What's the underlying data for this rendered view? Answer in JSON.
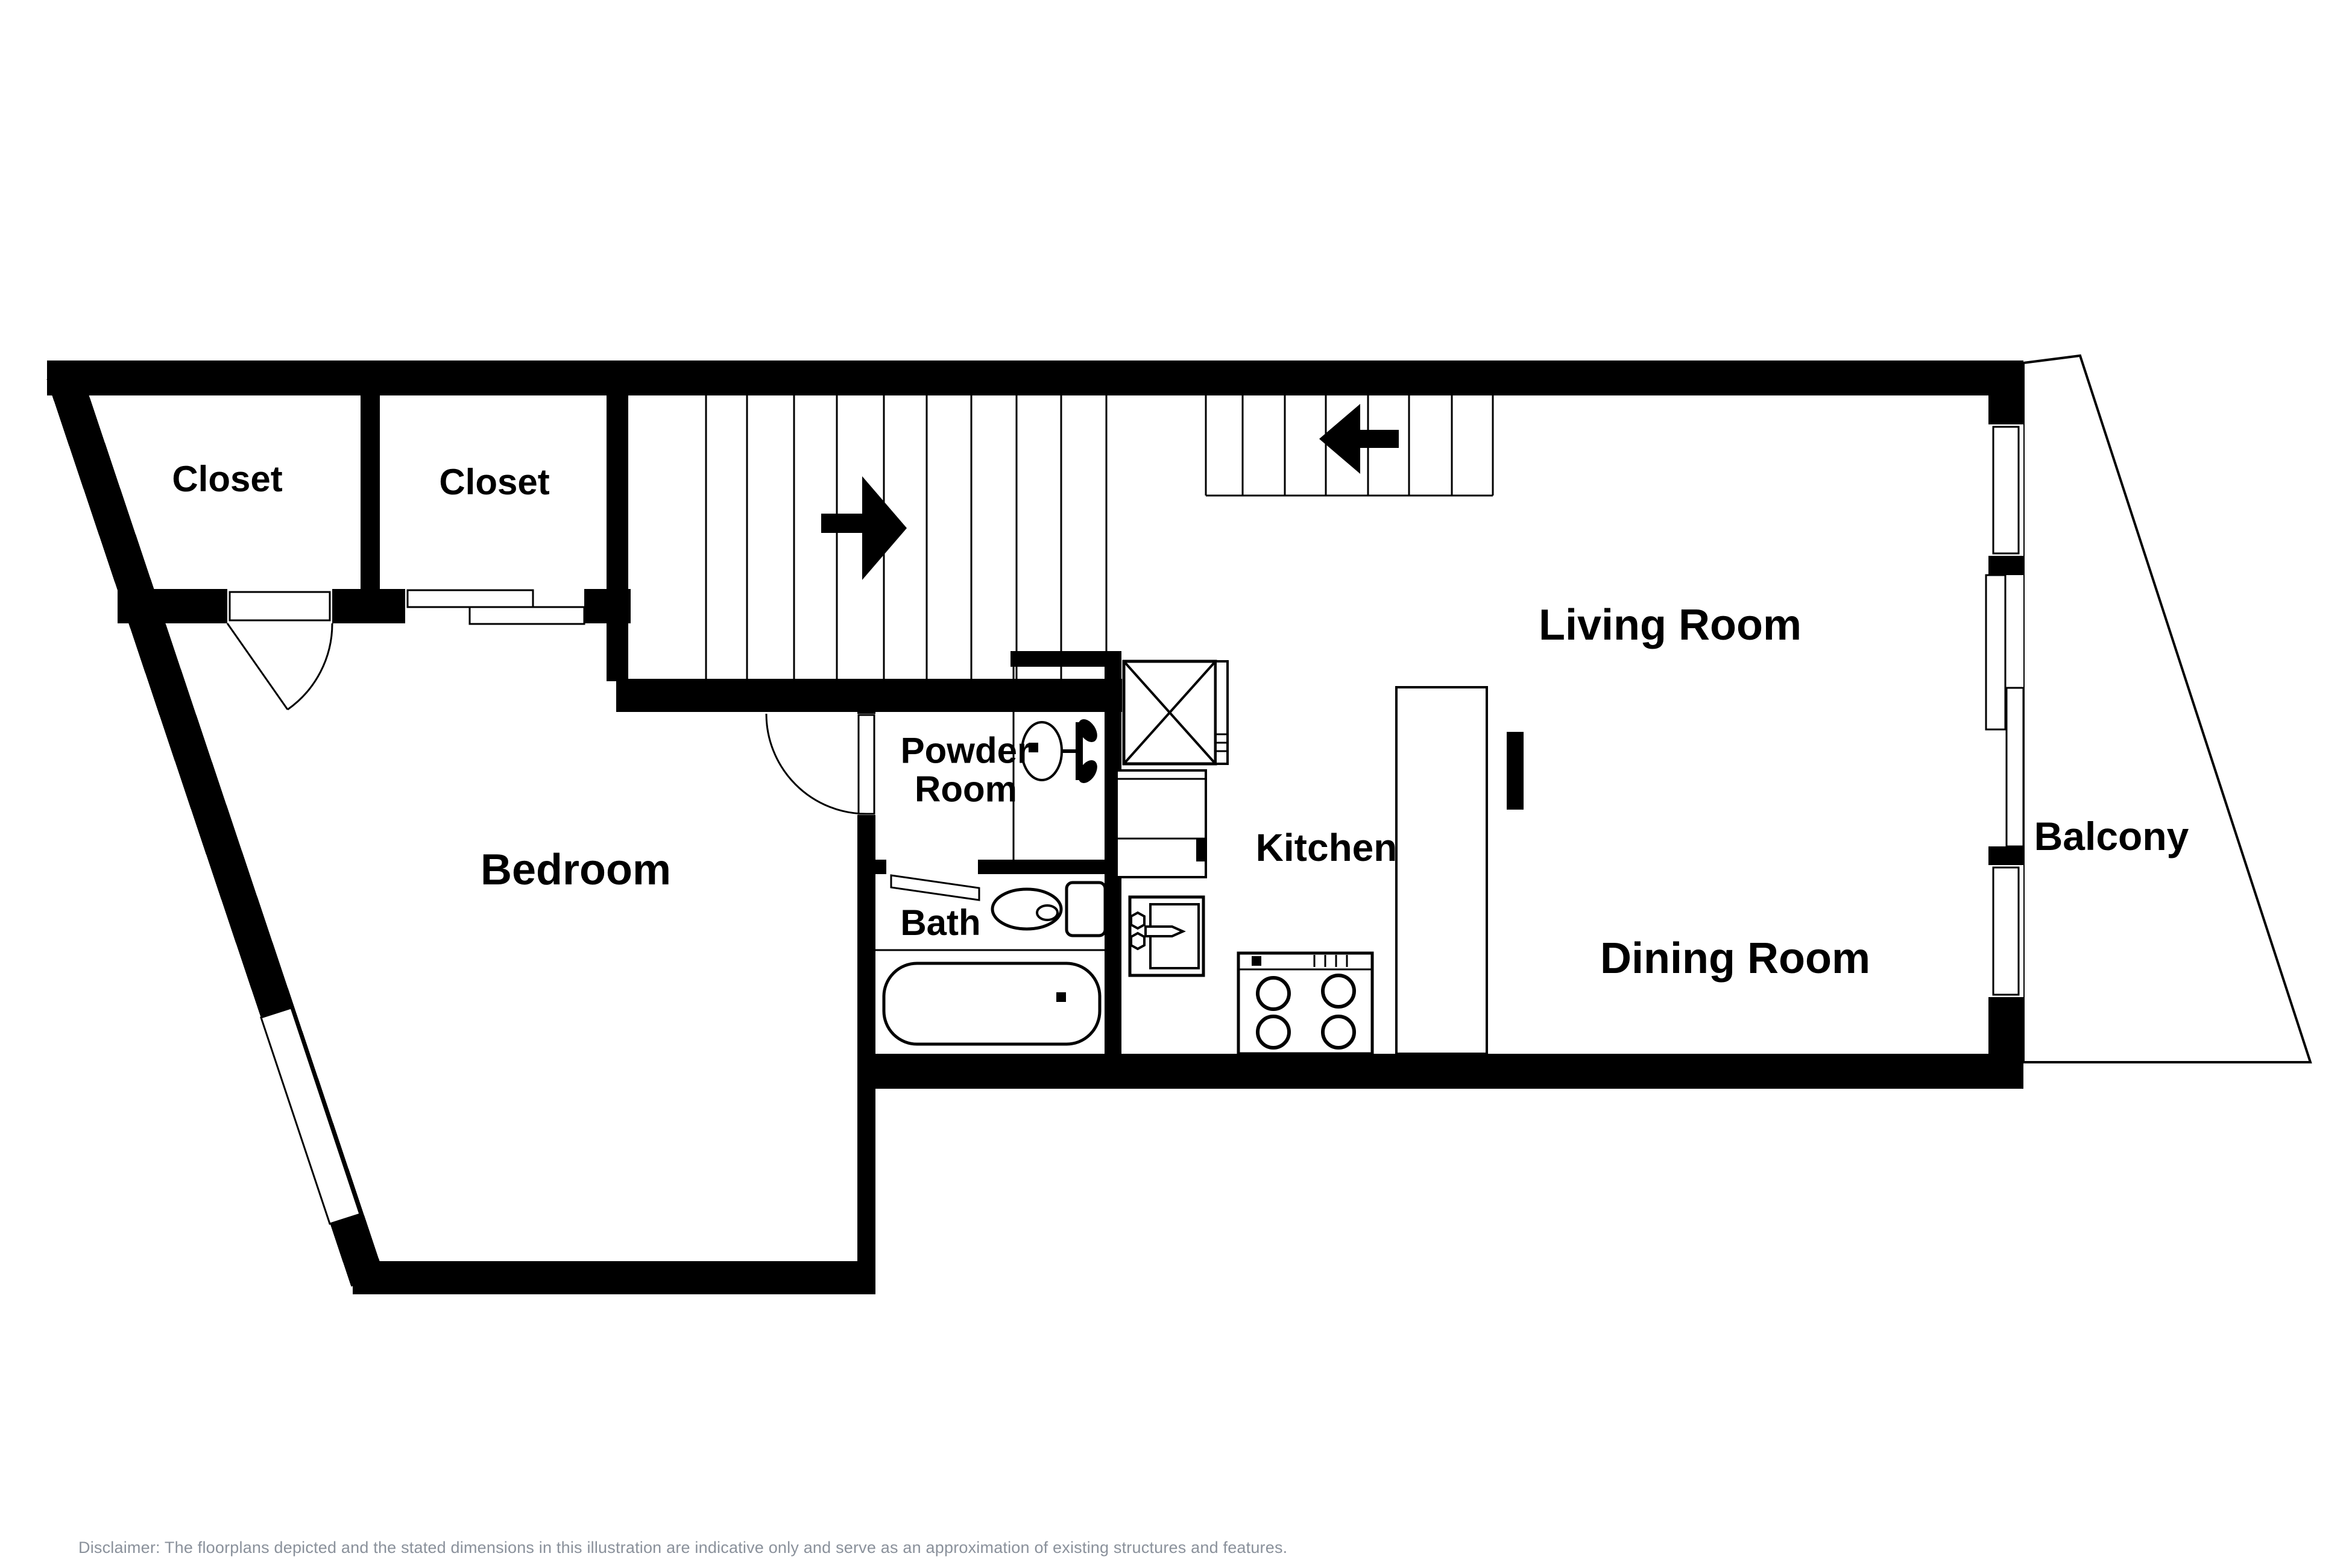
{
  "page": {
    "background_color": "#FFFFFF",
    "wall_color": "#000000",
    "label_color": "#000000"
  },
  "floorplan": {
    "labels": {
      "closet_left": "Closet",
      "closet_right": "Closet",
      "bedroom": "Bedroom",
      "powder_room": {
        "line1": "Powder",
        "line2": "Room"
      },
      "bath": "Bath",
      "kitchen": "Kitchen",
      "living_room": "Living Room",
      "dining_room": "Dining Room",
      "balcony": "Balcony"
    },
    "icons": {
      "stairs_arrow_right": "right-arrow",
      "stairs_arrow_left": "left-arrow",
      "fixtures": [
        "closet-door-swing",
        "bedroom-door-swing",
        "bath-door-leaf",
        "sliding-closet-door",
        "powder-sink",
        "toilet",
        "bathtub",
        "kitchen-x-cabinet",
        "kitchen-counter",
        "kitchen-sink",
        "stove-4-burners",
        "peninsula-counter",
        "window",
        "sliding-glass-door"
      ]
    }
  },
  "footer": {
    "disclaimer": "Disclaimer: The floorplans depicted and the stated dimensions in this illustration are indicative only and serve as an approximation of existing structures and features.",
    "text_color": "#8A919B"
  }
}
